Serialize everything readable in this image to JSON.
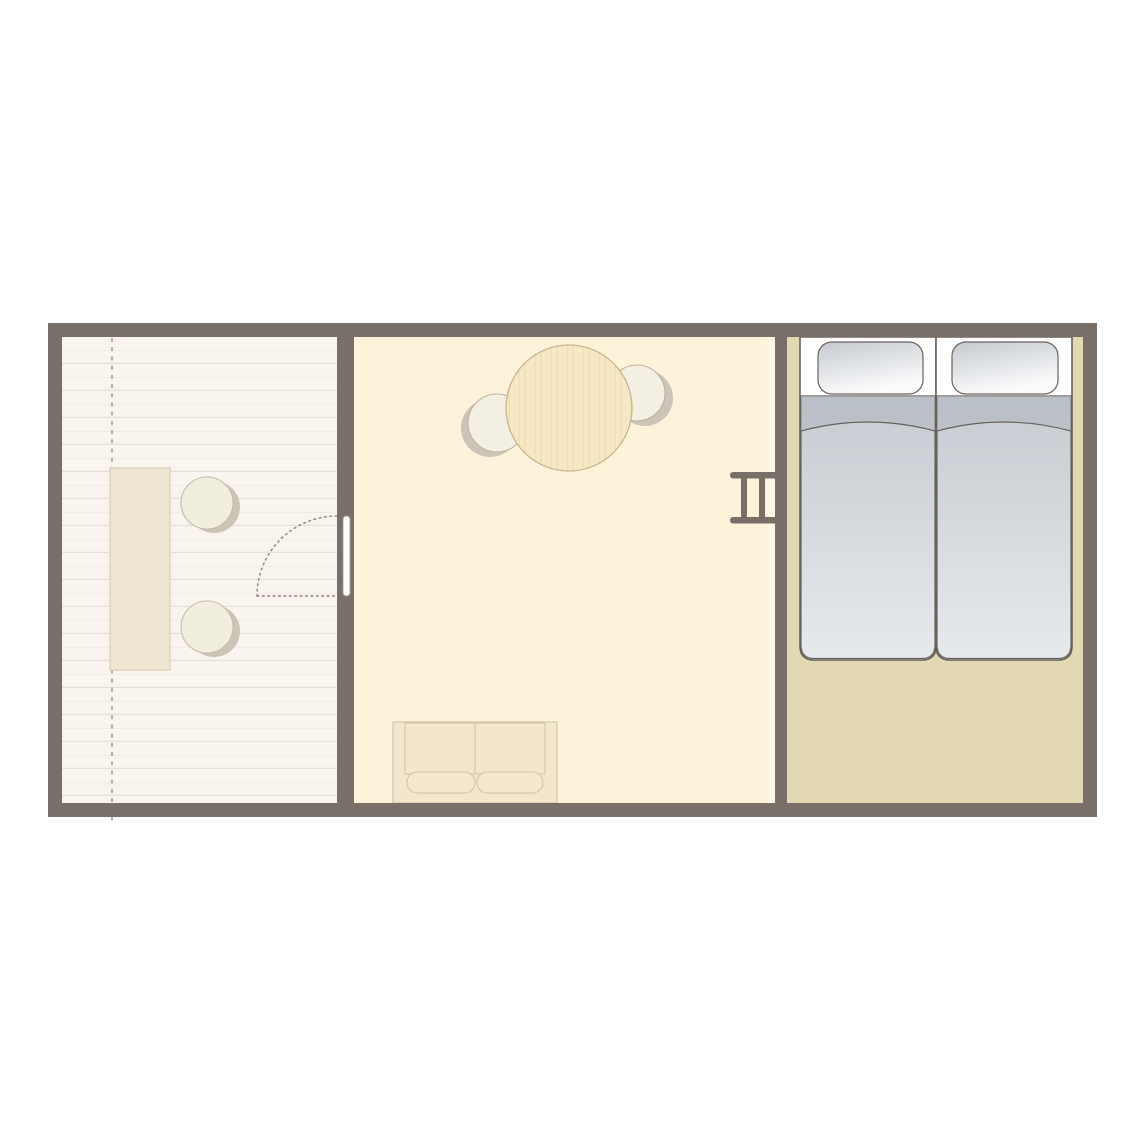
{
  "diagram": {
    "type": "floor-plan",
    "subject": "lodge-tent-floor-plan",
    "rooms": [
      {
        "id": "terrace",
        "label": "decked terrace",
        "furniture": [
          "rectangular table",
          "round stool",
          "round stool"
        ],
        "features": [
          "wood plank decking",
          "dashed canvas edge line"
        ]
      },
      {
        "id": "living-room",
        "label": "living room",
        "furniture": [
          "round dining table",
          "dining chair",
          "dining chair",
          "two-seat sofa"
        ],
        "features": [
          "door with swing arc to terrace",
          "ladder on bedroom wall"
        ]
      },
      {
        "id": "bedroom",
        "label": "bedroom",
        "furniture": [
          "single bed with pillow and duvet",
          "single bed with pillow and duvet"
        ]
      }
    ]
  },
  "colors": {
    "wall": "#796F69",
    "terrace-floor": "#F9F4EE",
    "plank-line": "#E6DFD5",
    "plank-line-faint": "#F1EBE3",
    "dotted-line": "#B9AFA3",
    "terrace-table-fill": "#F0E7D2",
    "terrace-table-stroke": "#D9CEB6",
    "stool-fill": "#F2EEDF",
    "stool-stroke": "#C6BCAA",
    "furniture-shadow": "#CCC4B7",
    "middle-floor": "#FDF3DB",
    "floor-highlight": "#FFF8E8",
    "table-wood": "#F7E9C8",
    "table-grain": "#EDDAAE",
    "table-stroke": "#C9B488",
    "chair-fill": "#F3EFE3",
    "chair-stroke": "#BEB39F",
    "sofa-fill": "#F2E7CC",
    "sofa-cushion": "#F4E9CF",
    "sofa-stroke": "#CBBFA4",
    "door-leaf-stroke": "#A49B91",
    "door-swing": "#8A8179",
    "bedroom-floor": "#E2D8B4",
    "bed-outline": "#68625C",
    "pillow-grad-start": "#C5C9CF",
    "pillow-grad-end": "#FBFCFD",
    "duvet-grad-start": "#C6CBD1",
    "duvet-grad-end": "#E6E9EC",
    "duvet-fold-shade": "#AEB4BC"
  }
}
